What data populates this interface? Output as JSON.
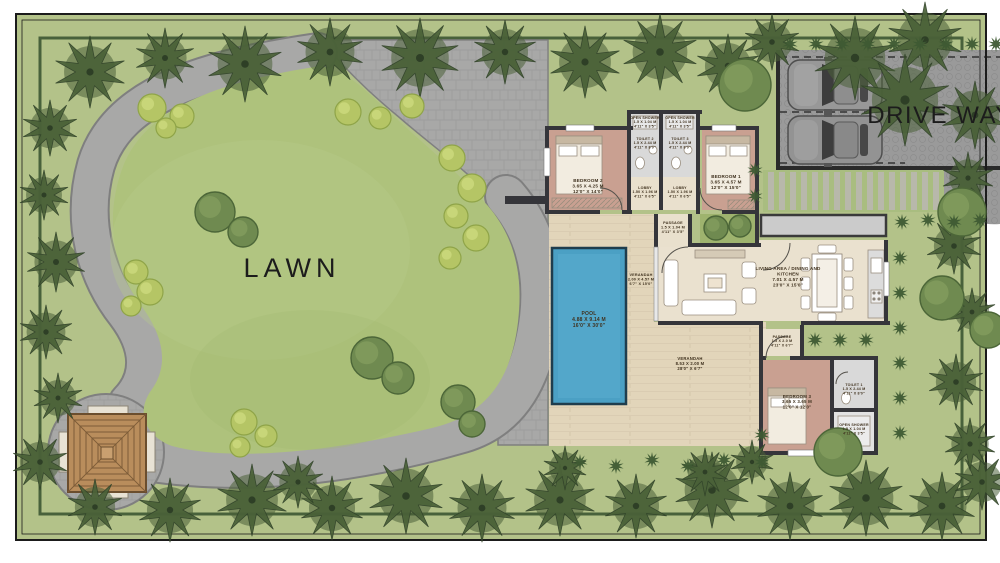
{
  "areas": {
    "lawn": {
      "label": "LAWN",
      "x": 292,
      "y": 277,
      "size": 27
    },
    "driveway": {
      "label": "DRIVE WAY",
      "x": 888,
      "y": 123,
      "size": 24,
      "cars_parked": 2
    }
  },
  "palette": {
    "site_green": "#b3c289",
    "lawn": "#aec27c",
    "path_gray": "#a8a8a7",
    "path_edge": "#7f7f7f",
    "pool": "#4ba0c4",
    "deck_wood": "#e2d5ba",
    "room_pink": "#c9a091",
    "bath_gray": "#d9d9d9",
    "floor_cream": "#eae1cf",
    "wall_dark": "#35353a",
    "tree_dark": "#4a6138",
    "tree_round": "#6f8a50",
    "bush_light": "#b5c565",
    "drive_paving": "#9a9a9a",
    "slab_gray": "#cbcbcb",
    "gazebo_wood": "#b98d5c"
  },
  "rooms": [
    {
      "id": "bedroom-2",
      "x": 588,
      "y": 182,
      "size": 4.6,
      "lines": [
        "BEDROOM 2",
        "3.65 X 4.25 M",
        "12'0\" X 14'0\""
      ]
    },
    {
      "id": "open-shower-2",
      "x": 645,
      "y": 119,
      "size": 3.6,
      "lines": [
        "OPEN SHOWER",
        "1.5 X 1.04 M",
        "4'11\" X 3'5\""
      ]
    },
    {
      "id": "open-shower-3",
      "x": 680,
      "y": 119,
      "size": 3.6,
      "lines": [
        "OPEN SHOWER",
        "1.5 X 1.04 M",
        "4'11\" X 3'5\""
      ]
    },
    {
      "id": "toilet-2",
      "x": 645,
      "y": 140,
      "size": 3.6,
      "lines": [
        "TOILET 2",
        "1.5 X 2.44 M",
        "4'11\" X 8'0\""
      ]
    },
    {
      "id": "toilet-3",
      "x": 680,
      "y": 140,
      "size": 3.6,
      "lines": [
        "TOILET 3",
        "1.5 X 2.44 M",
        "4'11\" X 8'0\""
      ]
    },
    {
      "id": "lobby-1",
      "x": 645,
      "y": 189,
      "size": 3.6,
      "lines": [
        "LOBBY",
        "1.50 X 1.96 M",
        "4'11\" X 6'5\""
      ]
    },
    {
      "id": "lobby-2",
      "x": 680,
      "y": 189,
      "size": 3.6,
      "lines": [
        "LOBBY",
        "1.50 X 1.96 M",
        "4'11\" X 6'5\""
      ]
    },
    {
      "id": "bedroom-1",
      "x": 726,
      "y": 178,
      "size": 4.6,
      "lines": [
        "BEDROOM 1",
        "3.65 X 4.57 M",
        "12'0\" X 15'0\""
      ]
    },
    {
      "id": "passage-1",
      "x": 673,
      "y": 224,
      "size": 3.8,
      "lines": [
        "PASSAGE",
        "1.5 X 1.04 M",
        "4'11\" X 3'5\""
      ]
    },
    {
      "id": "verandah-1",
      "x": 641,
      "y": 276,
      "size": 3.8,
      "lines": [
        "VERANDAH",
        "2.00 X 4.57 M",
        "6'7\" X 15'0\""
      ]
    },
    {
      "id": "pool",
      "x": 589,
      "y": 315,
      "size": 5,
      "lines": [
        "POOL",
        "4.88 X 9.14 M",
        "16'0\" X 30'0\""
      ]
    },
    {
      "id": "living",
      "x": 788,
      "y": 270,
      "size": 4.6,
      "lines": [
        "LIVING AREA / DINING AND",
        "KITCHEN",
        "7.01 X 4.57 M",
        "23'0\" X 15'0\""
      ]
    },
    {
      "id": "verandah-2",
      "x": 690,
      "y": 360,
      "size": 4.2,
      "lines": [
        "VERANDAH",
        "8.53 X 2.00 M",
        "28'0\" X 6'7\""
      ]
    },
    {
      "id": "passage-2",
      "x": 782,
      "y": 338,
      "size": 3.6,
      "lines": [
        "PASSAGE",
        "1.5 X 2.0 M",
        "4'11\" X 6'7\""
      ]
    },
    {
      "id": "bedroom-3",
      "x": 797,
      "y": 398,
      "size": 4.4,
      "lines": [
        "BEDROOM 3",
        "3.65 X 3.65 M",
        "12'0\" X 12'0\""
      ]
    },
    {
      "id": "toilet-1",
      "x": 854,
      "y": 386,
      "size": 3.6,
      "lines": [
        "TOILET 1",
        "1.5 X 2.44 M",
        "4'11\" X 8'0\""
      ]
    },
    {
      "id": "open-shower-1",
      "x": 854,
      "y": 426,
      "size": 3.6,
      "lines": [
        "OPEN SHOWER",
        "1.5 X 1.04 M",
        "4'11\" X 3'5\""
      ]
    }
  ],
  "landscape": {
    "palms": [
      [
        90,
        72,
        36
      ],
      [
        165,
        58,
        30
      ],
      [
        245,
        64,
        38
      ],
      [
        330,
        52,
        34
      ],
      [
        420,
        58,
        40
      ],
      [
        505,
        52,
        32
      ],
      [
        585,
        62,
        36
      ],
      [
        660,
        52,
        38
      ],
      [
        728,
        66,
        32
      ],
      [
        772,
        42,
        28
      ],
      [
        855,
        58,
        42
      ],
      [
        925,
        40,
        38
      ],
      [
        905,
        100,
        46
      ],
      [
        975,
        115,
        34
      ],
      [
        50,
        128,
        28
      ],
      [
        44,
        195,
        25
      ],
      [
        56,
        262,
        30
      ],
      [
        46,
        332,
        27
      ],
      [
        58,
        398,
        25
      ],
      [
        40,
        462,
        28
      ],
      [
        95,
        507,
        28
      ],
      [
        170,
        510,
        32
      ],
      [
        252,
        500,
        36
      ],
      [
        332,
        508,
        32
      ],
      [
        406,
        496,
        38
      ],
      [
        482,
        508,
        34
      ],
      [
        560,
        500,
        36
      ],
      [
        636,
        506,
        32
      ],
      [
        712,
        490,
        38
      ],
      [
        790,
        506,
        34
      ],
      [
        866,
        498,
        38
      ],
      [
        942,
        506,
        34
      ],
      [
        982,
        482,
        28
      ],
      [
        968,
        178,
        26
      ],
      [
        954,
        246,
        28
      ],
      [
        972,
        312,
        24
      ],
      [
        956,
        382,
        28
      ],
      [
        970,
        444,
        26
      ],
      [
        298,
        482,
        26
      ],
      [
        565,
        468,
        22
      ],
      [
        705,
        472,
        24
      ],
      [
        752,
        462,
        22
      ]
    ],
    "round_trees": [
      [
        215,
        212,
        20
      ],
      [
        243,
        232,
        15
      ],
      [
        372,
        358,
        21
      ],
      [
        398,
        378,
        16
      ],
      [
        458,
        402,
        17
      ],
      [
        472,
        424,
        13
      ],
      [
        716,
        228,
        12
      ],
      [
        740,
        226,
        11
      ],
      [
        745,
        85,
        26
      ],
      [
        962,
        212,
        24
      ],
      [
        942,
        298,
        22
      ],
      [
        988,
        330,
        18
      ],
      [
        838,
        452,
        24
      ]
    ],
    "bushes": [
      [
        152,
        108,
        14
      ],
      [
        182,
        116,
        12
      ],
      [
        166,
        128,
        10
      ],
      [
        348,
        112,
        13
      ],
      [
        380,
        118,
        11
      ],
      [
        412,
        106,
        12
      ],
      [
        452,
        158,
        13
      ],
      [
        472,
        188,
        14
      ],
      [
        456,
        216,
        12
      ],
      [
        476,
        238,
        13
      ],
      [
        450,
        258,
        11
      ],
      [
        136,
        272,
        12
      ],
      [
        150,
        292,
        13
      ],
      [
        131,
        306,
        10
      ],
      [
        244,
        422,
        13
      ],
      [
        266,
        436,
        11
      ],
      [
        240,
        447,
        10
      ]
    ],
    "shrubs": [
      [
        790,
        44
      ],
      [
        816,
        44
      ],
      [
        842,
        44
      ],
      [
        868,
        44
      ],
      [
        894,
        44
      ],
      [
        920,
        44
      ],
      [
        946,
        44
      ],
      [
        972,
        44
      ],
      [
        996,
        44
      ],
      [
        902,
        222
      ],
      [
        928,
        220
      ],
      [
        954,
        222
      ],
      [
        980,
        220
      ],
      [
        900,
        258
      ],
      [
        900,
        293
      ],
      [
        900,
        328
      ],
      [
        900,
        363
      ],
      [
        900,
        398
      ],
      [
        900,
        433
      ],
      [
        815,
        340
      ],
      [
        840,
        340
      ],
      [
        866,
        340
      ],
      [
        755,
        170
      ],
      [
        755,
        196
      ],
      [
        580,
        462
      ],
      [
        616,
        466
      ],
      [
        652,
        460
      ],
      [
        688,
        466
      ],
      [
        724,
        460
      ],
      [
        762,
        435
      ],
      [
        762,
        462
      ]
    ]
  }
}
